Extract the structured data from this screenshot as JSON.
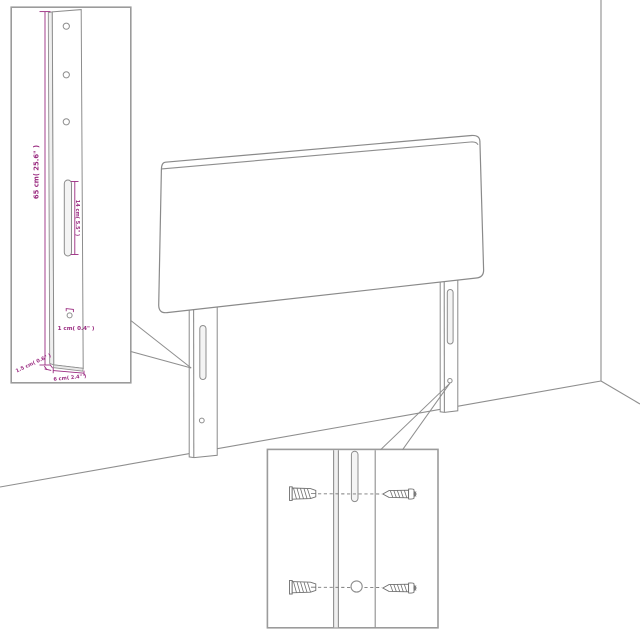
{
  "diagram": {
    "background": "#ffffff",
    "line_color": "#8e8e8e",
    "dimension_color": "#9a2b80",
    "post_inset": {
      "post_height_label": "65 cm( 25.6\" )",
      "slot_length_label": "14 cm( 5.5\" )",
      "hole_diameter_label": "1 cm( 0.4\" )",
      "post_depth_label": "1.5 cm( 0.6\" )",
      "post_width_label": "6 cm( 2.4\" )"
    }
  }
}
